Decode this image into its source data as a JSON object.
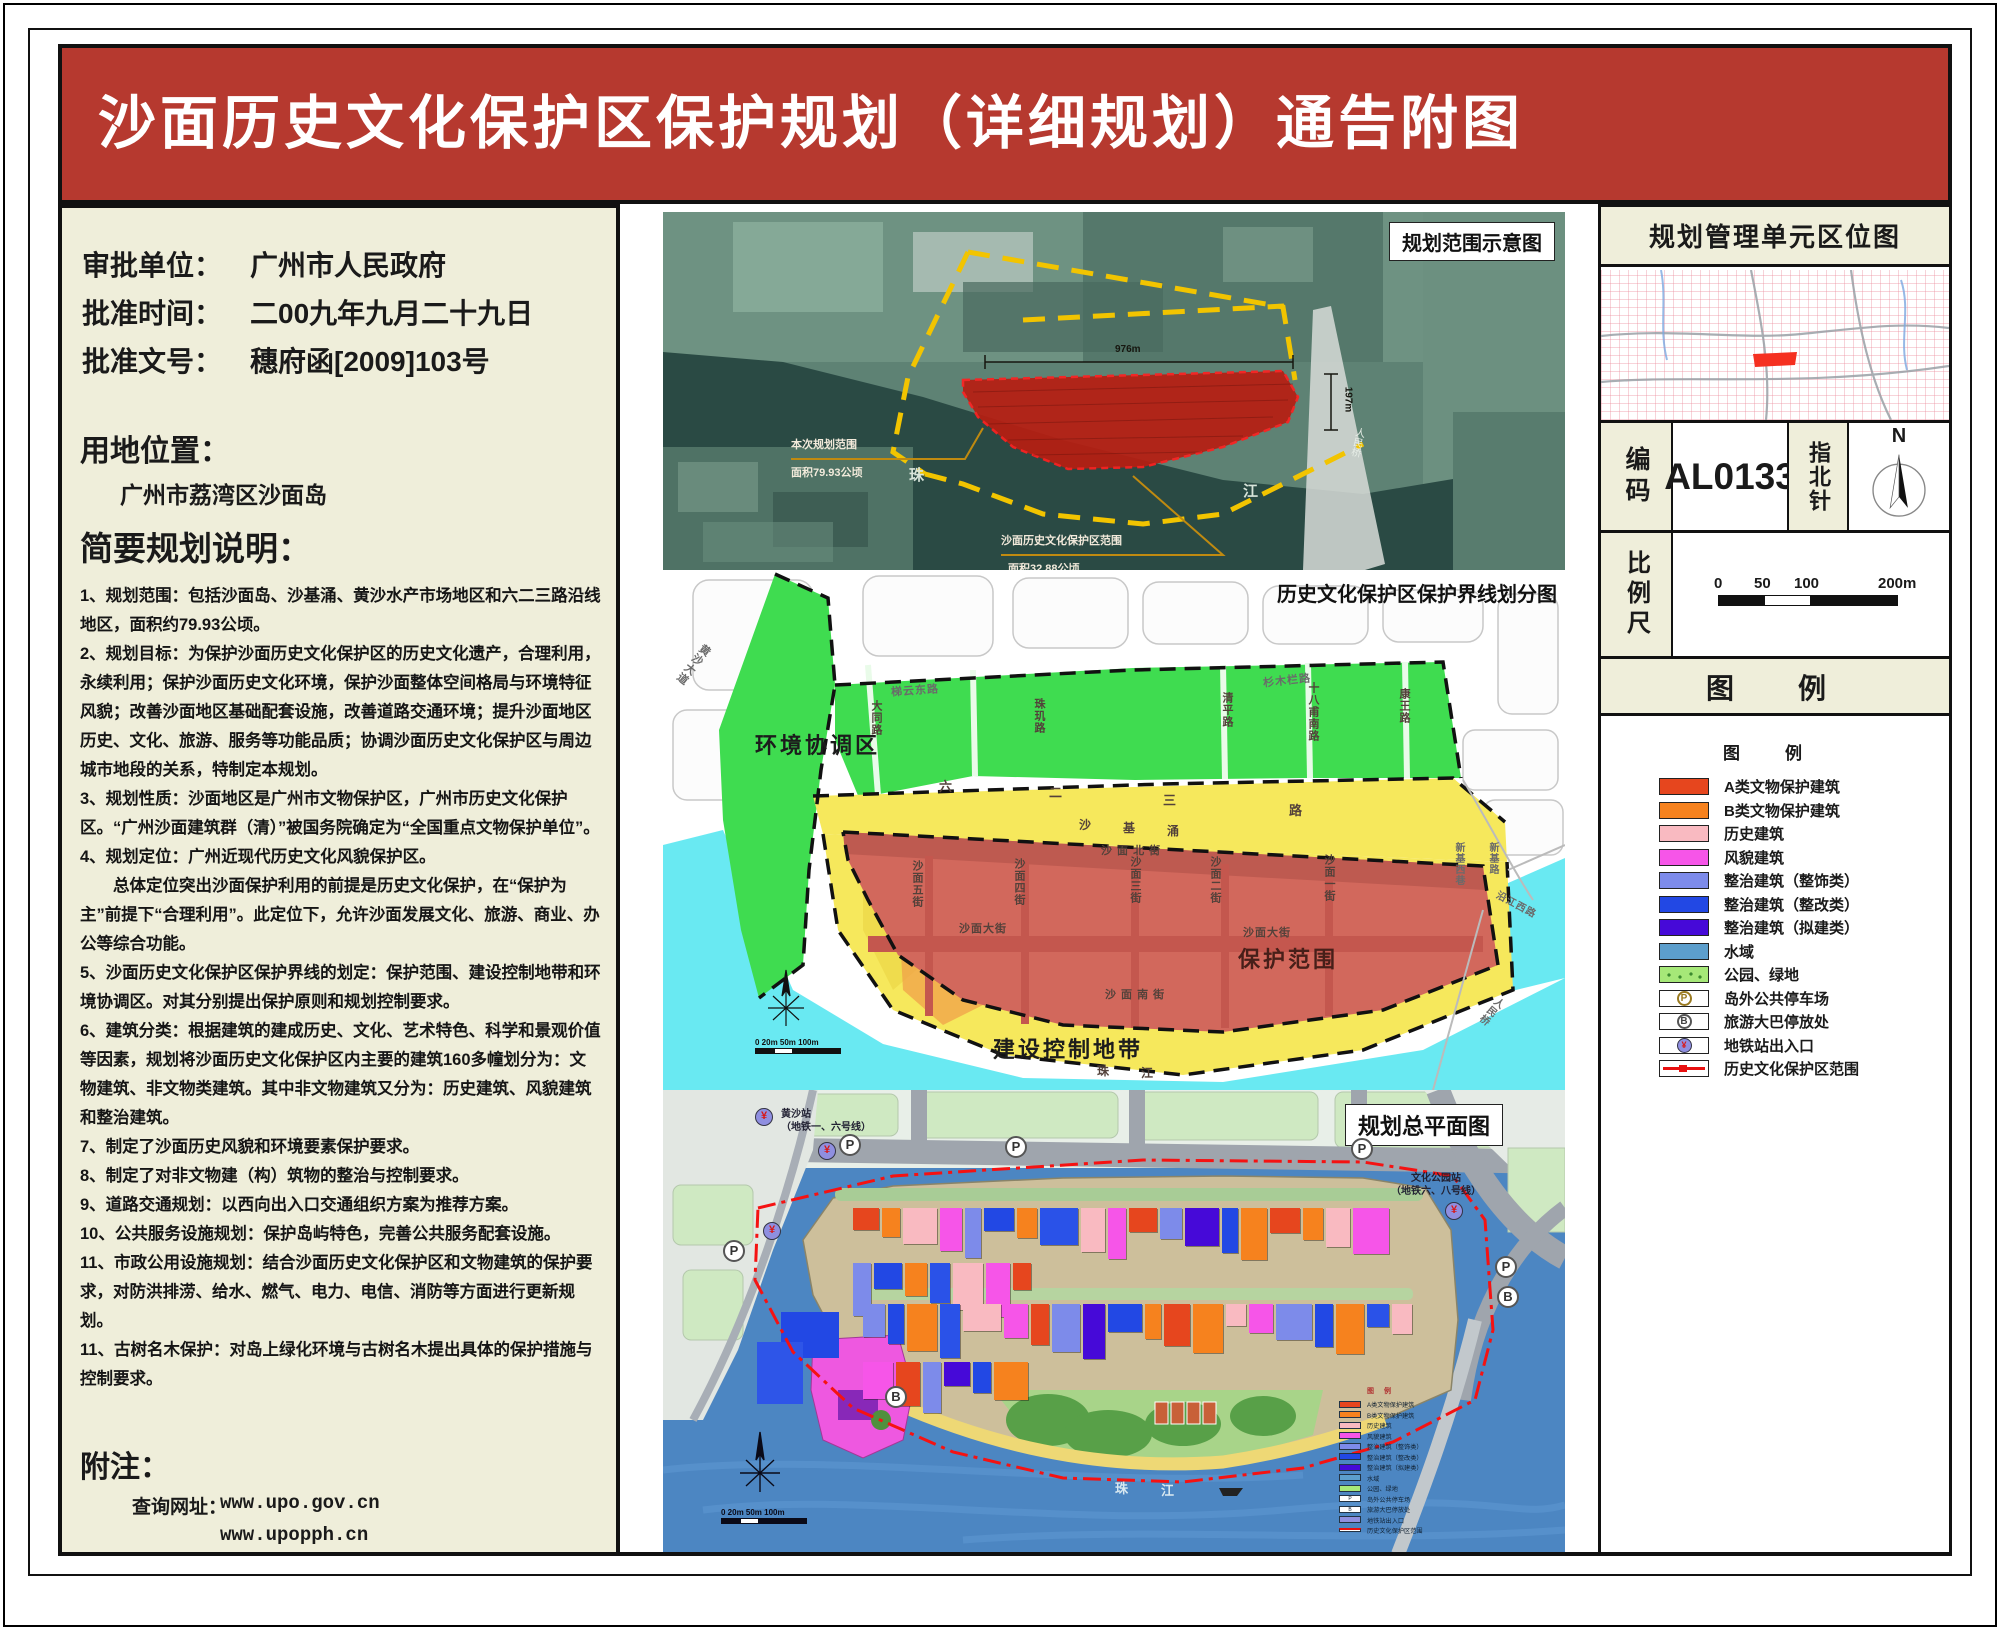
{
  "title": "沙面历史文化保护区保护规划（详细规划）通告附图",
  "colors": {
    "banner_red": "#B6392F",
    "panel_beige": "#EFEEDA",
    "zone_green": "#3FDC50",
    "zone_yellow": "#F6E85C",
    "zone_red": "#D2685C",
    "zone_water_cyan": "#69E9F2",
    "master_water_blue": "#4C86C2",
    "boundary_red": "#FF1414",
    "boundary_yellow": "#F2C400"
  },
  "left_panel": {
    "approval": [
      {
        "label": "审批单位：",
        "value": "广州市人民政府"
      },
      {
        "label": "批准时间：",
        "value": "二00九年九月二十九日"
      },
      {
        "label": "批准文号：",
        "value": "穗府函[2009]103号"
      }
    ],
    "location_heading": "用地位置：",
    "location_value": "广州市荔湾区沙面岛",
    "summary_heading": "简要规划说明：",
    "summary_items": [
      "1、规划范围：包括沙面岛、沙基涌、黄沙水产市场地区和六二三路沿线地区，面积约79.93公顷。",
      "2、规划目标：为保护沙面历史文化保护区的历史文化遗产，合理利用，永续利用；保护沙面历史文化环境，保护沙面整体空间格局与环境特征风貌；改善沙面地区基础配套设施，改善道路交通环境；提升沙面地区历史、文化、旅游、服务等功能品质；协调沙面历史文化保护区与周边城市地段的关系，特制定本规划。",
      "3、规划性质：沙面地区是广州市文物保护区，广州市历史文化保护区。“广州沙面建筑群（清）”被国务院确定为“全国重点文物保护单位”。",
      "4、规划定位：广州近现代历史文化风貌保护区。",
      "　　总体定位突出沙面保护利用的前提是历史文化保护，在“保护为主”前提下“合理利用”。此定位下，允许沙面发展文化、旅游、商业、办公等综合功能。",
      "5、沙面历史文化保护区保护界线的划定：保护范围、建设控制地带和环境协调区。对其分别提出保护原则和规划控制要求。",
      "6、建筑分类：根据建筑的建成历史、文化、艺术特色、科学和景观价值等因素，规划将沙面历史文化保护区内主要的建筑160多幢划分为：文物建筑、非文物类建筑。其中非文物建筑又分为：历史建筑、风貌建筑和整治建筑。",
      "7、制定了沙面历史风貌和环境要素保护要求。",
      "8、制定了对非文物建（构）筑物的整治与控制要求。",
      "9、道路交通规划：以西向出入口交通组织方案为推荐方案。",
      "10、公共服务设施规划：保护岛屿特色，完善公共服务配套设施。",
      "11、市政公用设施规划：结合沙面历史文化保护区和文物建筑的保护要求，对防洪排涝、给水、燃气、电力、电信、消防等方面进行更新规划。",
      "11、古树名木保护：对岛上绿化环境与古树名木提出具体的保护措施与控制要求。"
    ],
    "notes_heading": "附注：",
    "notes_label": "查询网址：",
    "notes_urls": [
      "www.upo.gov.cn",
      "www.upopph.cn"
    ]
  },
  "maps": {
    "satellite": {
      "title": "规划范围示意图",
      "label_plan_scope": "本次规划范围",
      "label_plan_area": "面积79.93公顷",
      "label_reserve_scope": "沙面历史文化保护区范围",
      "label_reserve_area": "面积32.88公顷",
      "pearl": [
        "珠",
        "江"
      ],
      "dim_h": "976m",
      "dim_v": "197m",
      "bridge": "人民桥"
    },
    "zoning": {
      "title": "历史文化保护区保护界线划分图",
      "zone_green_label": "环境协调区",
      "zone_yellow_label": "建设控制地带",
      "zone_red_label": "保护范围",
      "streets": {
        "tiyun": "梯云东路",
        "datong": "大同路",
        "zhuji": "珠玑路",
        "qingping": "清平路",
        "shibafu": "十八甫南路",
        "shanmulan": "杉木栏路",
        "kangwang": "康王路",
        "huangsha": "黄沙大道",
        "l623": [
          "六",
          "二",
          "三",
          "路"
        ],
        "shaji": [
          "沙",
          "基",
          "涌"
        ],
        "north_st": "沙 面 北 街",
        "s5": "沙面五街",
        "s4": "沙面四街",
        "s3": "沙面三街",
        "s2": "沙面二街",
        "s1": "沙面一街",
        "main_w": "沙面大街",
        "main_e": "沙面大街",
        "south_st": "沙 面 南 街",
        "xinjixi": "新基西巷",
        "xinji": "新基路",
        "yanjiang": "沿江西路",
        "renmin": "人民桥",
        "pearl": [
          "珠",
          "江"
        ]
      },
      "scale_text": "0 20m 50m   100m",
      "north": "N"
    },
    "master": {
      "title": "规划总平面图",
      "station_left": "黄沙站",
      "station_left_sub": "（地铁一、六号线）",
      "station_right": "文化公园站",
      "station_right_sub": "（地铁六、八号线）",
      "pearl": [
        "珠",
        "江"
      ],
      "parking_symbol": "P",
      "bus_symbol": "B",
      "metro_symbol": "¥",
      "mini_legend_title": "图  例",
      "scale_text": "0 20m 50m   100m",
      "north": "N",
      "building_palette": [
        "#E6461E",
        "#F6821E",
        "#F9BAC1",
        "#F655E8",
        "#7D8BEA",
        "#2248E4",
        "#F6821E",
        "#2A52E8",
        "#F9BAC1",
        "#F655E8",
        "#E6461E",
        "#7D8BEA",
        "#4609D8",
        "#2248E4",
        "#F6821E"
      ]
    }
  },
  "right_panel": {
    "unit_map_title": "规划管理单元区位图",
    "code_label": "编码",
    "code_value": "AL0133",
    "compass_label": "指北针",
    "compass_n": "N",
    "scale_label": "比例尺",
    "scale_ticks": [
      "0",
      "50",
      "100",
      "200m"
    ],
    "legend_header": "图　例",
    "legend_subtitle": "图　例",
    "legend_items": [
      {
        "label": "A类文物保护建筑",
        "color": "#E6461E",
        "type": "swatch"
      },
      {
        "label": "B类文物保护建筑",
        "color": "#F6821E",
        "type": "swatch"
      },
      {
        "label": "历史建筑",
        "color": "#F9BAC1",
        "type": "swatch"
      },
      {
        "label": "风貌建筑",
        "color": "#F655E8",
        "type": "swatch"
      },
      {
        "label": "整治建筑（整饰类）",
        "color": "#7D8BEA",
        "type": "swatch"
      },
      {
        "label": "整治建筑（整改类）",
        "color": "#2248E4",
        "type": "swatch"
      },
      {
        "label": "整治建筑（拟建类）",
        "color": "#4609D8",
        "type": "swatch"
      },
      {
        "label": "水域",
        "color": "#5C9ECC",
        "type": "swatch"
      },
      {
        "label": "公园、绿地",
        "color": "#A6E878",
        "type": "park"
      },
      {
        "label": "岛外公共停车场",
        "symbol": "P",
        "type": "parking"
      },
      {
        "label": "旅游大巴停放处",
        "symbol": "B",
        "type": "bus"
      },
      {
        "label": "地铁站出入口",
        "symbol": "¥",
        "type": "metro"
      },
      {
        "label": "历史文化保护区范围",
        "type": "boundary"
      }
    ]
  }
}
